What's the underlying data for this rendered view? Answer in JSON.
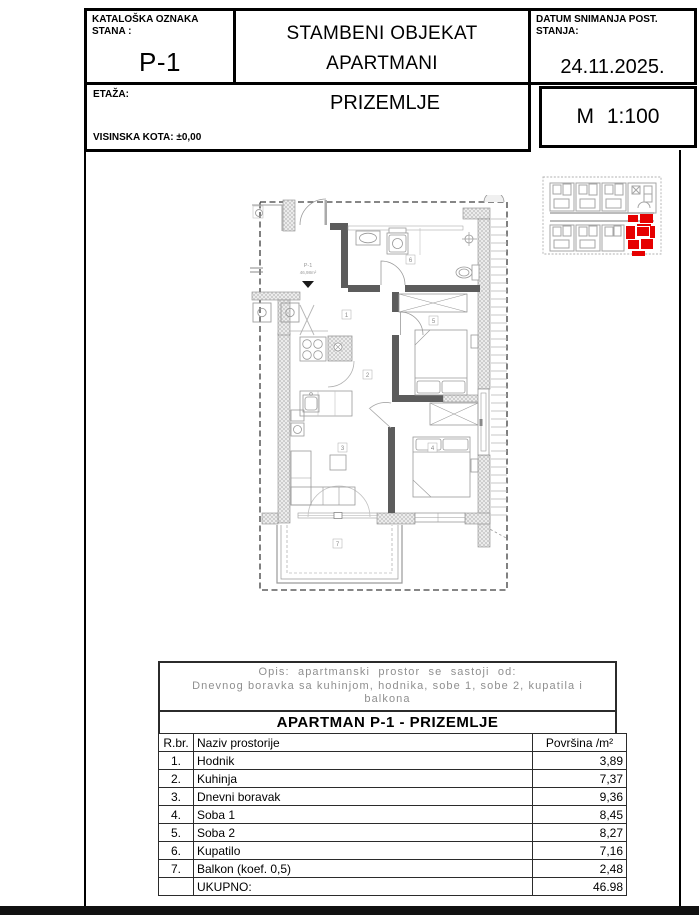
{
  "header": {
    "catalog_label": "KATALOŠKA OZNAKA STANA :",
    "unit_code": "P-1",
    "title_line1": "STAMBENI OBJEKAT",
    "title_line2": "APARTMANI",
    "date_label": "DATUM SNIMANJA POST. STANJA:",
    "date_value": "24.11.2025.",
    "floor_label": "ETAŽA:",
    "floor_value": "PRIZEMLJE",
    "elevation_label": "VISINSKA KOTA:",
    "elevation_value": "±0,00",
    "scale_value": "M 1:100"
  },
  "plan": {
    "unit_label": "P-1",
    "unit_area": "46,98m²",
    "room_numbers": [
      "1",
      "2",
      "3",
      "4",
      "5",
      "6",
      "7"
    ]
  },
  "key_plan": {
    "highlight_color": "#e60000"
  },
  "table": {
    "description_line1": "Opis:  apartmanski  prostor  se  sastoji  od:",
    "description_line2": "Dnevnog boravka sa kuhinjom, hodnika, sobe 1, sobe 2, kupatila i",
    "description_line3": "balkona",
    "title": "APARTMAN P-1 - PRIZEMLJE",
    "col_num": "R.br.",
    "col_name": "Naziv prostorije",
    "col_area": "Površina /m²",
    "rows": [
      {
        "num": "1.",
        "name": "Hodnik",
        "area": "3,89"
      },
      {
        "num": "2.",
        "name": "Kuhinja",
        "area": "7,37"
      },
      {
        "num": "3.",
        "name": "Dnevni boravak",
        "area": "9,36"
      },
      {
        "num": "4.",
        "name": "Soba 1",
        "area": "8,45"
      },
      {
        "num": "5.",
        "name": "Soba 2",
        "area": "8,27"
      },
      {
        "num": "6.",
        "name": "Kupatilo",
        "area": "7,16"
      },
      {
        "num": "7.",
        "name": "Balkon (koef. 0,5)",
        "area": "2,48"
      }
    ],
    "total_label": "UKUPNO:",
    "total_value": "46.98"
  }
}
